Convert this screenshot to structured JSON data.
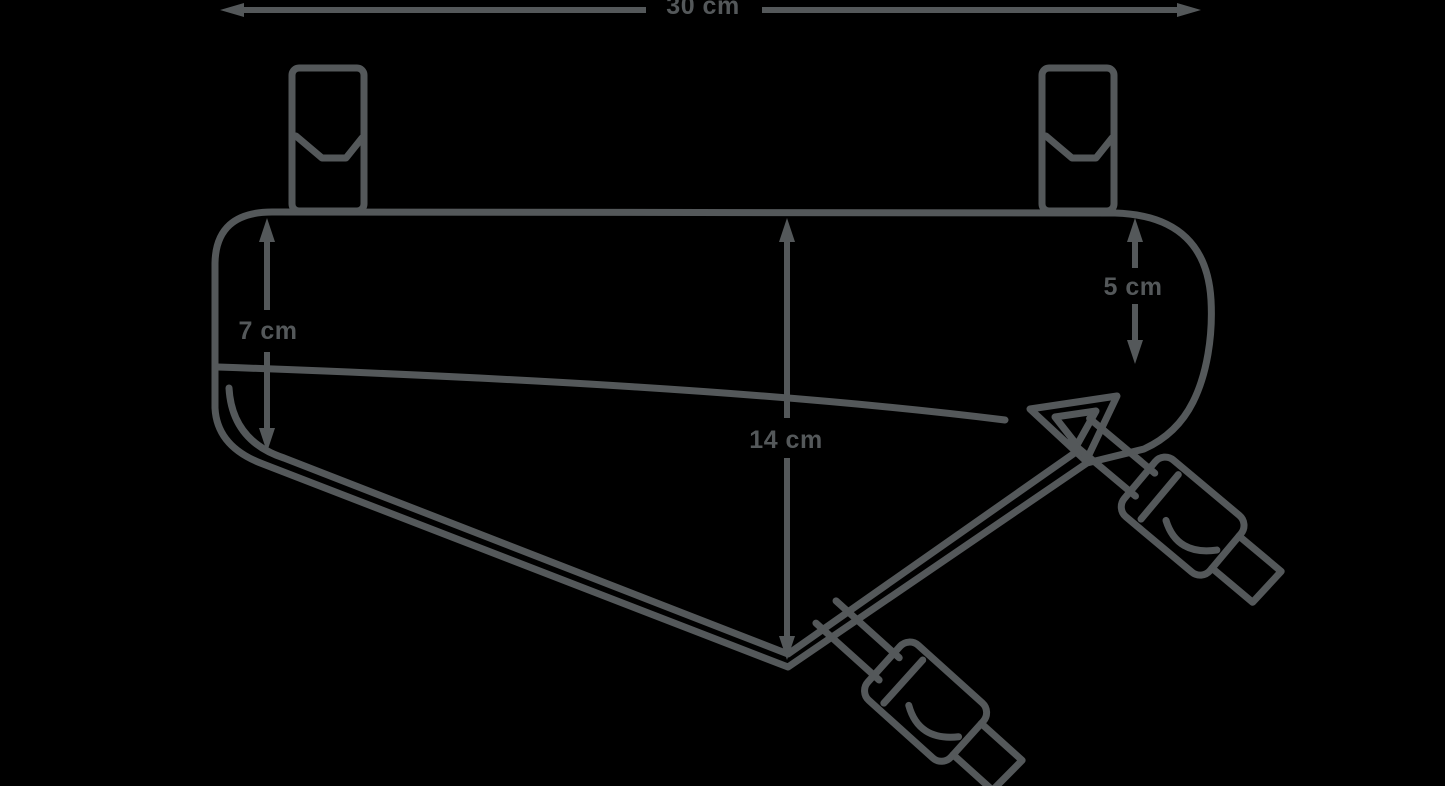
{
  "figure": {
    "kind": "product-dimension-diagram",
    "subject": "bicycle frame bag line drawing with two top mounting straps and two buckle straps",
    "background_color": "#000000",
    "line_color": "#54585A"
  },
  "labels": {
    "width": "30 cm",
    "front_height": "7 cm",
    "max_height": "14 cm",
    "rear_height": "5 cm"
  }
}
